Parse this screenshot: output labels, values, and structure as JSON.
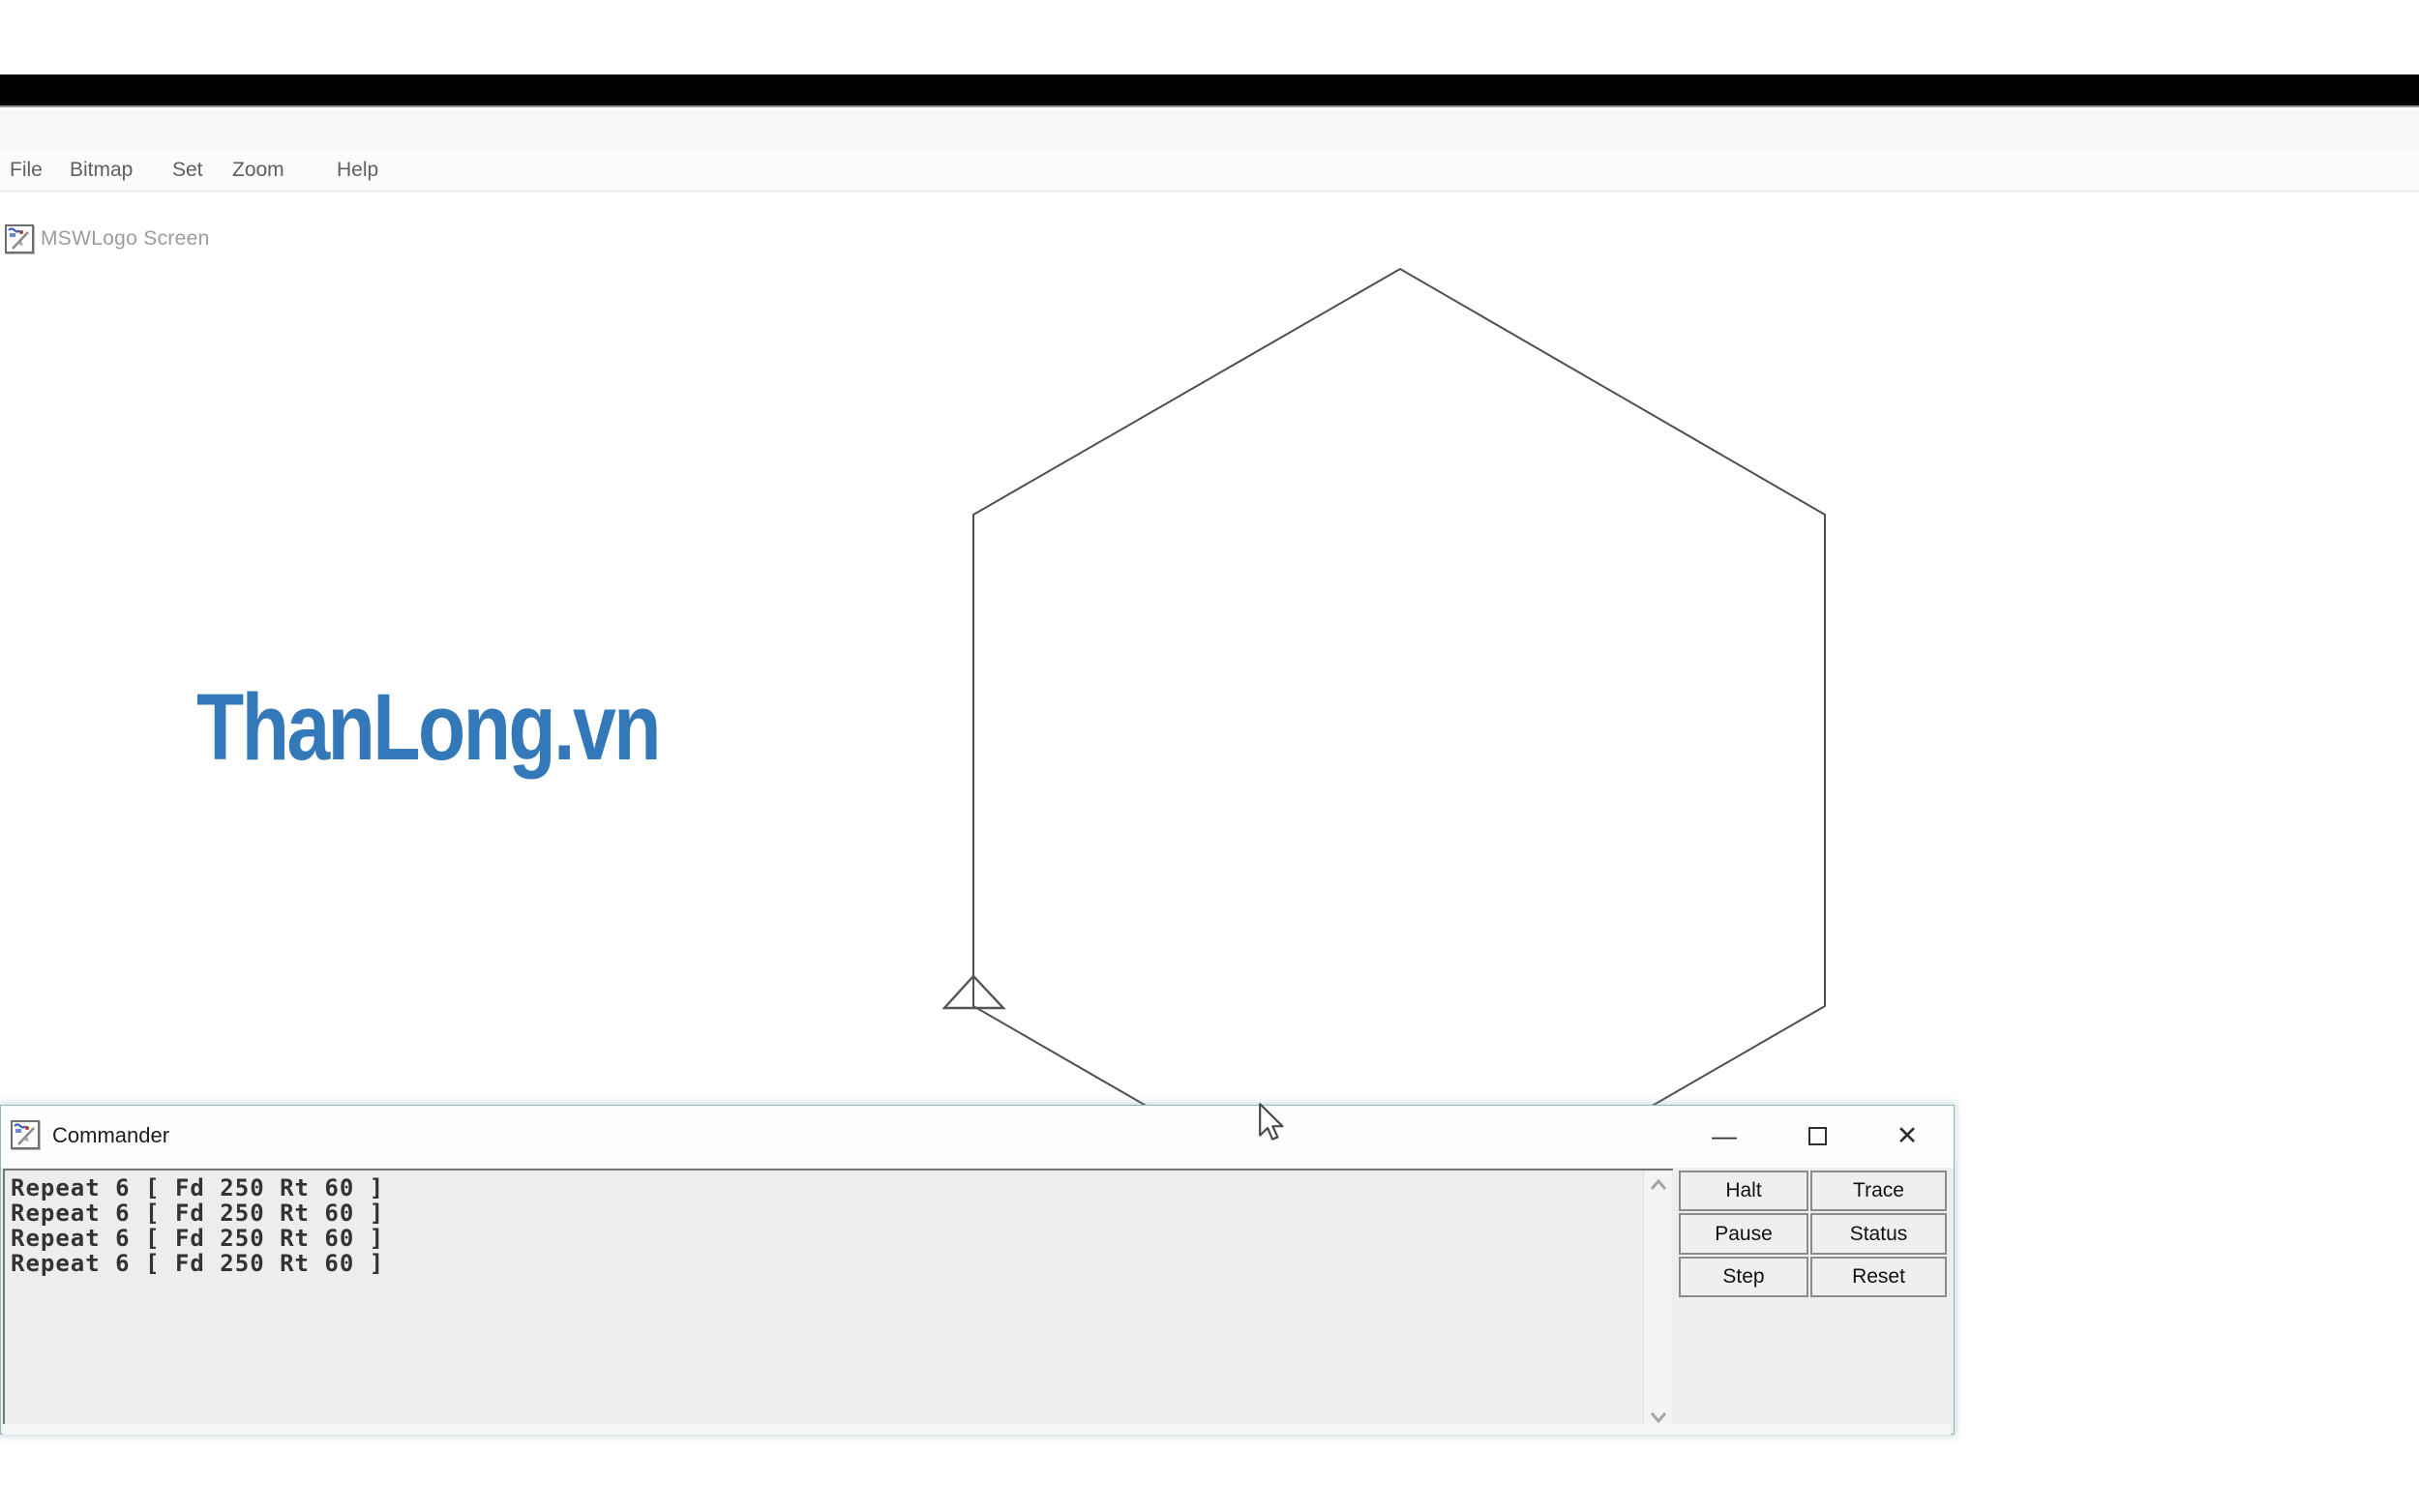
{
  "app": {
    "title": "MSWLogo Screen",
    "menu_items": [
      "File",
      "Bitmap",
      "Set",
      "Zoom",
      "Help"
    ]
  },
  "canvas": {
    "watermark_text": "ThanLong.vn",
    "watermark_color": "#3378b8",
    "hexagon_points": "1006,1040 1006,532 1447,278 1886,532 1886,1040 1446,1294",
    "turtle_points": "1006,1009 976,1042 1037,1042",
    "line_color": "#4f4f4f"
  },
  "commander": {
    "title": "Commander",
    "history": [
      "Repeat 6 [ Fd 250 Rt 60 ]",
      "Repeat 6 [ Fd 250 Rt 60 ]",
      "Repeat 6 [ Fd 250 Rt 60 ]",
      "Repeat 6 [ Fd 250 Rt 60 ]"
    ],
    "input_value": "",
    "buttons": [
      "Halt",
      "Trace",
      "Pause",
      "Status",
      "Step",
      "Reset"
    ],
    "controls": {
      "minimize": "—",
      "close": "✕"
    },
    "border_color": "#8fb9bd"
  }
}
